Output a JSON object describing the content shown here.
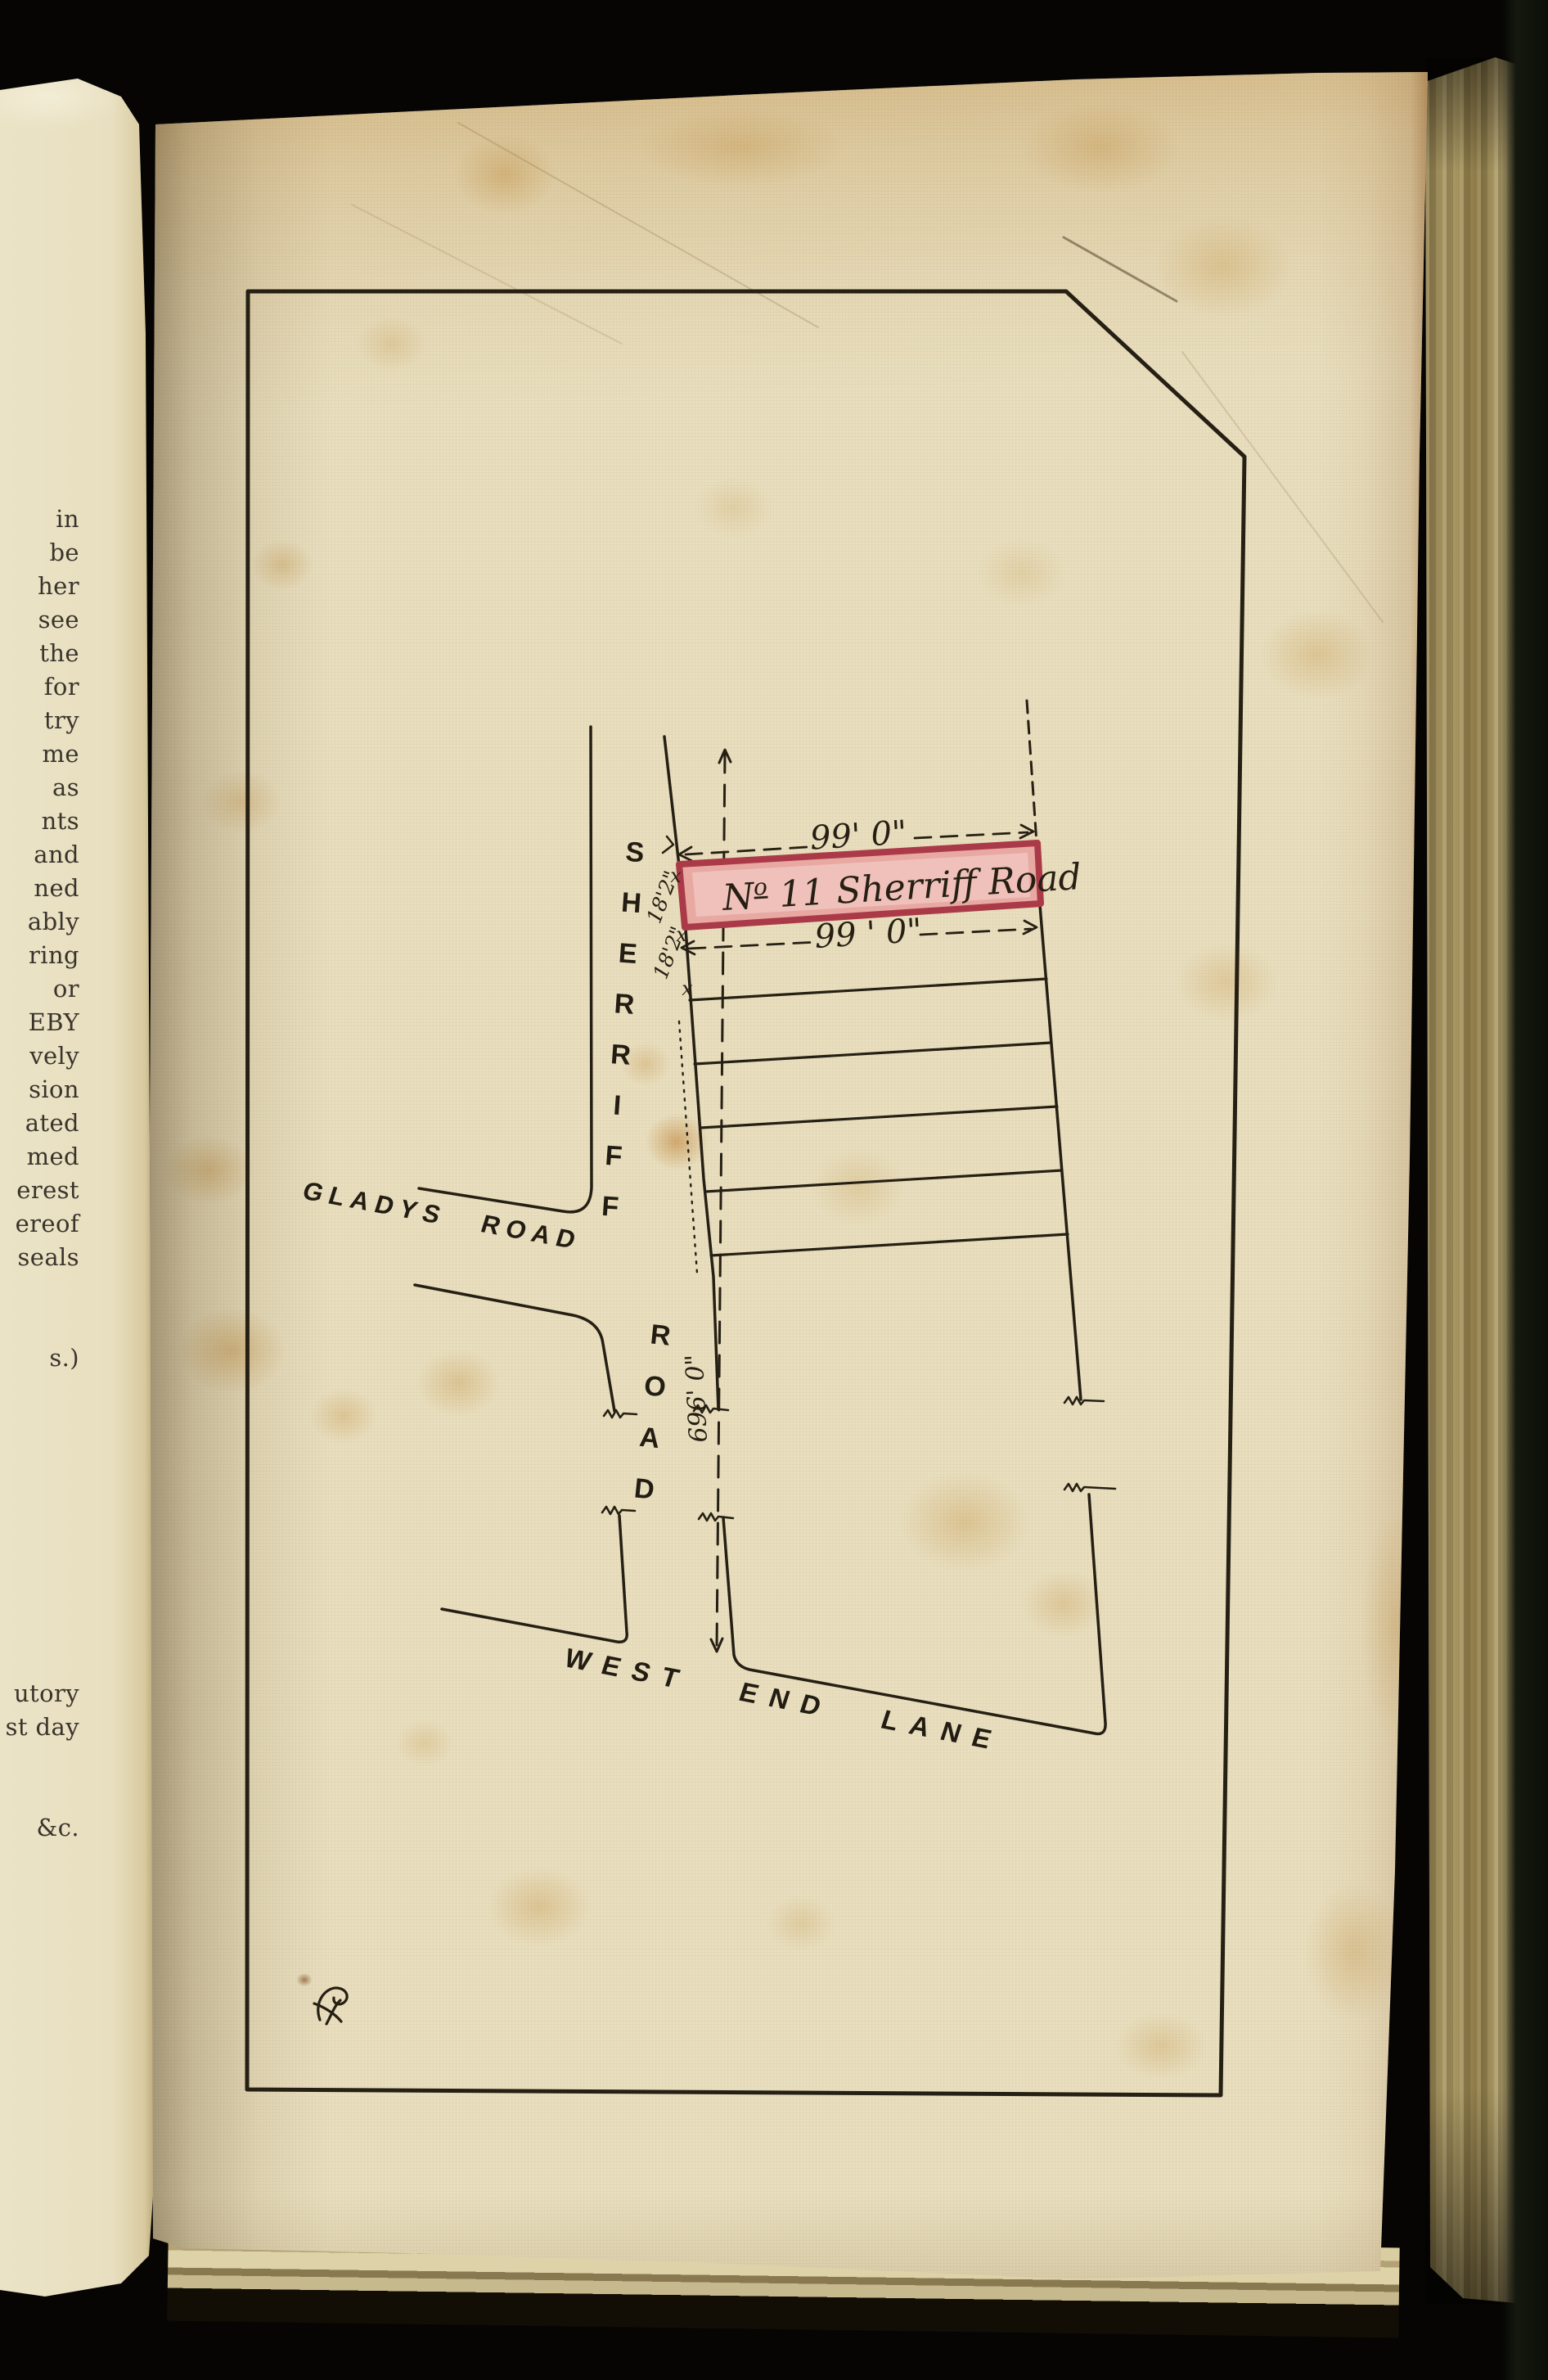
{
  "left_page": {
    "fragments": "in\nbe\nher\nsee\nthe\nfor\ntry\nme\nas\nnts\nand\nned\nably\nring\nor\nEBY\nvely\nsion\nated\nmed\nerest\nereof\nseals\n\n\ns.)\n\n\n\n\n\n\n\n\n\nutory\nst day\n\n\n&c."
  },
  "plan": {
    "ink_color": "#261f13",
    "plot": {
      "prefix": "N",
      "ordinal": "o",
      "rest": "11 Sherriff Road",
      "label_text": "No. 11 Sherriff Road",
      "fill_color": "#e8a9a3",
      "border_color": "#ab3a49"
    },
    "dimensions": {
      "top": "99' 0\"",
      "bottom": "99 ' 0\"",
      "frontage_total": "696' 0\"",
      "frontage": "18'2\"",
      "tick": "x"
    },
    "roads": {
      "sherriff_word1": "SHERRIFF",
      "sherriff_word2": "ROAD",
      "gladys": "GLADYS ROAD",
      "west_end": "WEST END LANE"
    }
  }
}
